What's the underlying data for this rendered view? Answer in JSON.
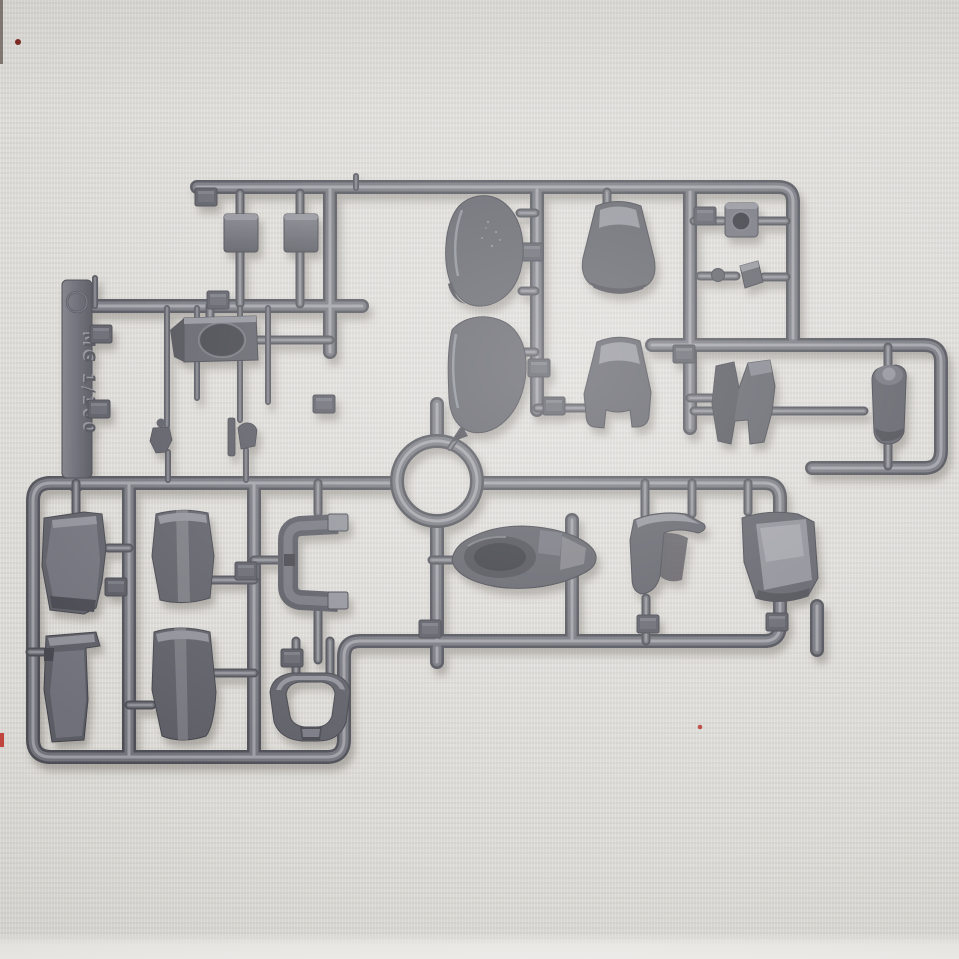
{
  "scene": {
    "description": "Photograph of a dark gray injection-molded plastic model-kit sprue (parts runner) lying on a light woven fabric background",
    "background_color": "#d9d7d2",
    "bottom_strip_color": "#ecebe7",
    "shadow_color": "#6b665e"
  },
  "sprue": {
    "plastic_base": "#5c5c65",
    "plastic_dark": "#4a4a53",
    "plastic_mid": "#71717a",
    "plastic_light": "#9b9ba4",
    "part_count": 22,
    "number_tab_count": 16,
    "has_ring_junction": true,
    "has_right_loop": true
  },
  "markings": {
    "runner_label": "MG 1/100",
    "label_style": "molded raised lettering, vertical, on flat side tab",
    "circle_mark": "embossed circular mark above label",
    "number_tabs_note": "small molded part-number squares on runners (digits not legible)"
  },
  "parts": {
    "items": [
      "small mounting plate A",
      "small mounting plate B",
      "canopy shell upper",
      "collar armor upper",
      "square grommet with hole",
      "small wedge block",
      "head visor block with oval opening",
      "pilot figure standing",
      "pilot figure seated",
      "canopy shell lower",
      "collar armor with prongs",
      "angular claw fin",
      "ankle cylinder joint",
      "thigh shell left",
      "thigh shell right",
      "c-shaped clamp",
      "cockpit hatch with oval recess",
      "shoulder shell curved",
      "shoulder shell glossy face",
      "shin shell notched",
      "shin shell rounded",
      "waist frame ring"
    ]
  },
  "artifacts": {
    "red_marks": [
      "red dash on left edge",
      "dark red dot top-left",
      "small red speck lower-right"
    ]
  }
}
